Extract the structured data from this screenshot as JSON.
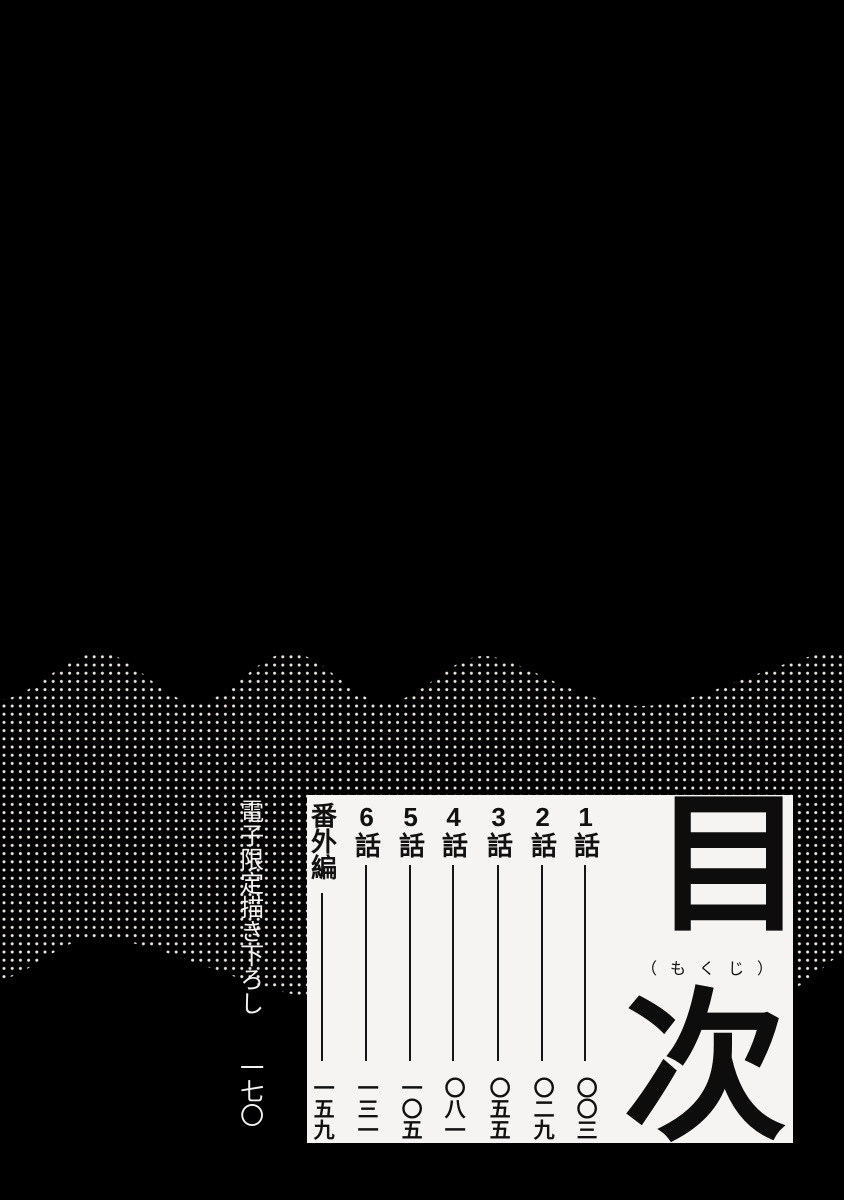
{
  "page": {
    "background_color": "#000000",
    "paper_color": "#f6f4f2",
    "ink_color": "#111111",
    "halftone_dot_color": "#efe7e4",
    "title": {
      "main": "目次",
      "char_top": "目",
      "char_bottom": "次",
      "reading": "（もくじ）"
    },
    "toc": {
      "entries": [
        {
          "label": "1話",
          "page": "〇〇三"
        },
        {
          "label": "2話",
          "page": "〇二九"
        },
        {
          "label": "3話",
          "page": "〇五五"
        },
        {
          "label": "4話",
          "page": "〇八一"
        },
        {
          "label": "5話",
          "page": "一〇五"
        },
        {
          "label": "6話",
          "page": "一三一"
        },
        {
          "label": "番外編",
          "page": "一五九"
        }
      ]
    },
    "bonus": {
      "label": "電子限定描き下ろし",
      "page": "一七〇"
    }
  }
}
